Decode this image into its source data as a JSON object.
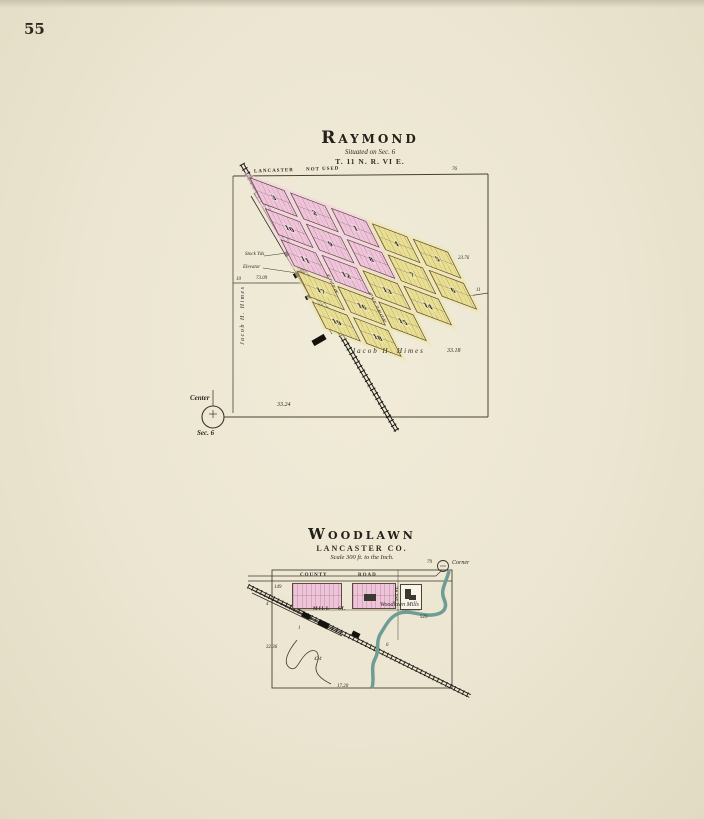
{
  "page": {
    "number": "55"
  },
  "raymond": {
    "title": "Raymond",
    "situated": "Situated on Sec. 6",
    "township": "T. 11 N.  R. VI E.",
    "top_street": {
      "left": "LANCASTER",
      "right": "NOT USED"
    },
    "streets": {
      "maple": "MAPLE",
      "howland": "HOWLAND"
    },
    "labels": {
      "stock_yds": "Stock Yds",
      "elevator": "Elevator",
      "owner_left": "Jacob H. Himes",
      "owner_bottom": "Jacob H. Himes",
      "center": "Center",
      "center_sec": "Sec. 6"
    },
    "numbers": {
      "left_dist": "73.09",
      "bottom_dist": "33.24",
      "bottom_right_dist": "33.18",
      "right_dist": "23.76",
      "tick_top_right": "76",
      "tick_left": "10",
      "tick_right": "11"
    },
    "blocks": [
      {
        "n": "3",
        "c": 0,
        "r": 0,
        "f": "p"
      },
      {
        "n": "2",
        "c": 1,
        "r": 0,
        "f": "p"
      },
      {
        "n": "1",
        "c": 2,
        "r": 0,
        "f": "p"
      },
      {
        "n": "4",
        "c": 3,
        "r": 0,
        "f": "y"
      },
      {
        "n": "5",
        "c": 4,
        "r": 0,
        "f": "y"
      },
      {
        "n": "10",
        "c": 0,
        "r": 1,
        "f": "p"
      },
      {
        "n": "9",
        "c": 1,
        "r": 1,
        "f": "p"
      },
      {
        "n": "8",
        "c": 2,
        "r": 1,
        "f": "p"
      },
      {
        "n": "7",
        "c": 3,
        "r": 1,
        "f": "y"
      },
      {
        "n": "6",
        "c": 4,
        "r": 1,
        "f": "y"
      },
      {
        "n": "11",
        "c": 0,
        "r": 2,
        "f": "p"
      },
      {
        "n": "12",
        "c": 1,
        "r": 2,
        "f": "p"
      },
      {
        "n": "13",
        "c": 2,
        "r": 2,
        "f": "y"
      },
      {
        "n": "14",
        "c": 3,
        "r": 2,
        "f": "y"
      },
      {
        "n": "17",
        "c": 0,
        "r": 3,
        "f": "y"
      },
      {
        "n": "16",
        "c": 1,
        "r": 3,
        "f": "y"
      },
      {
        "n": "15",
        "c": 2,
        "r": 3,
        "f": "y"
      },
      {
        "n": "19",
        "c": 0,
        "r": 4,
        "f": "y"
      },
      {
        "n": "18",
        "c": 1,
        "r": 4,
        "f": "y"
      }
    ]
  },
  "woodlawn": {
    "title": "Woodlawn",
    "county": "LANCASTER CO.",
    "scale": "Scale 300 ft. to the Inch.",
    "roads": {
      "county": "COUNTY",
      "road": "ROAD",
      "mill": "MILL",
      "st": "ST.",
      "first_st": "1ST ST."
    },
    "labels": {
      "mills": "Woodlawn Mills",
      "corner": "Corner"
    },
    "numbers": {
      "n149": "149",
      "n79": "79",
      "n529": "529",
      "n3236": "32.36",
      "n434": "434",
      "n1720": "17.20",
      "n4": "4",
      "n6": "6",
      "n1": "1"
    }
  }
}
